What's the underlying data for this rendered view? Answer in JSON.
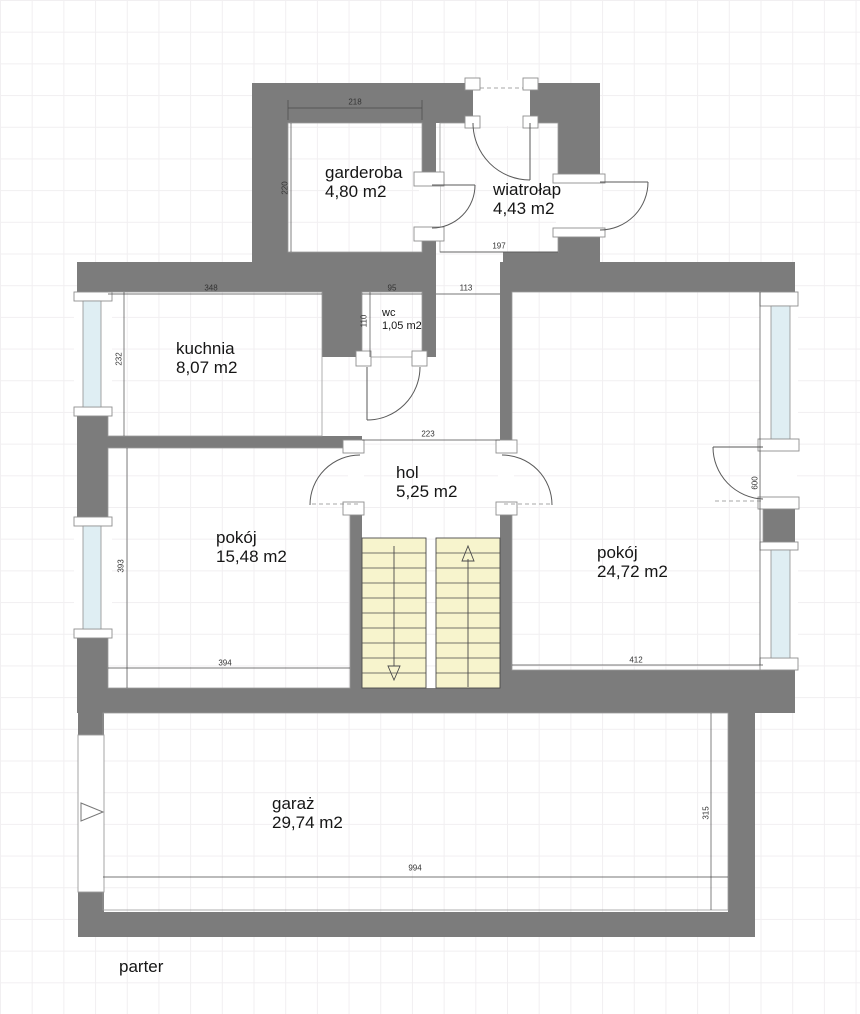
{
  "plan": {
    "floor_label": "parter",
    "rooms": {
      "garderoba": {
        "name": "garderoba",
        "area": "4,80 m2"
      },
      "wiatrolap": {
        "name": "wiatrołap",
        "area": "4,43 m2"
      },
      "wc": {
        "name": "wc",
        "area": "1,05 m2"
      },
      "kuchnia": {
        "name": "kuchnia",
        "area": "8,07 m2"
      },
      "hol": {
        "name": "hol",
        "area": "5,25 m2"
      },
      "pokoj_left": {
        "name": "pokój",
        "area": "15,48 m2"
      },
      "pokoj_right": {
        "name": "pokój",
        "area": "24,72 m2"
      },
      "garaz": {
        "name": "garaż",
        "area": "29,74 m2"
      }
    },
    "dimensions_cm": {
      "garderoba_width": "218",
      "garderoba_depth": "220",
      "wiatrolap_width": "197",
      "wc_width": "95",
      "wc_depth": "110",
      "passage_width": "113",
      "kuchnia_width": "348",
      "kuchnia_depth": "232",
      "hol_width": "223",
      "pokoj_left_depth": "393",
      "pokoj_left_width": "394",
      "pokoj_right_width": "412",
      "pokoj_right_depth": "600",
      "garaz_width": "994",
      "garaz_depth": "315"
    },
    "colors": {
      "wall": "#7c7c7c",
      "stairs_fill": "#f7f4cd",
      "window_pane": "#dfeef3"
    }
  }
}
